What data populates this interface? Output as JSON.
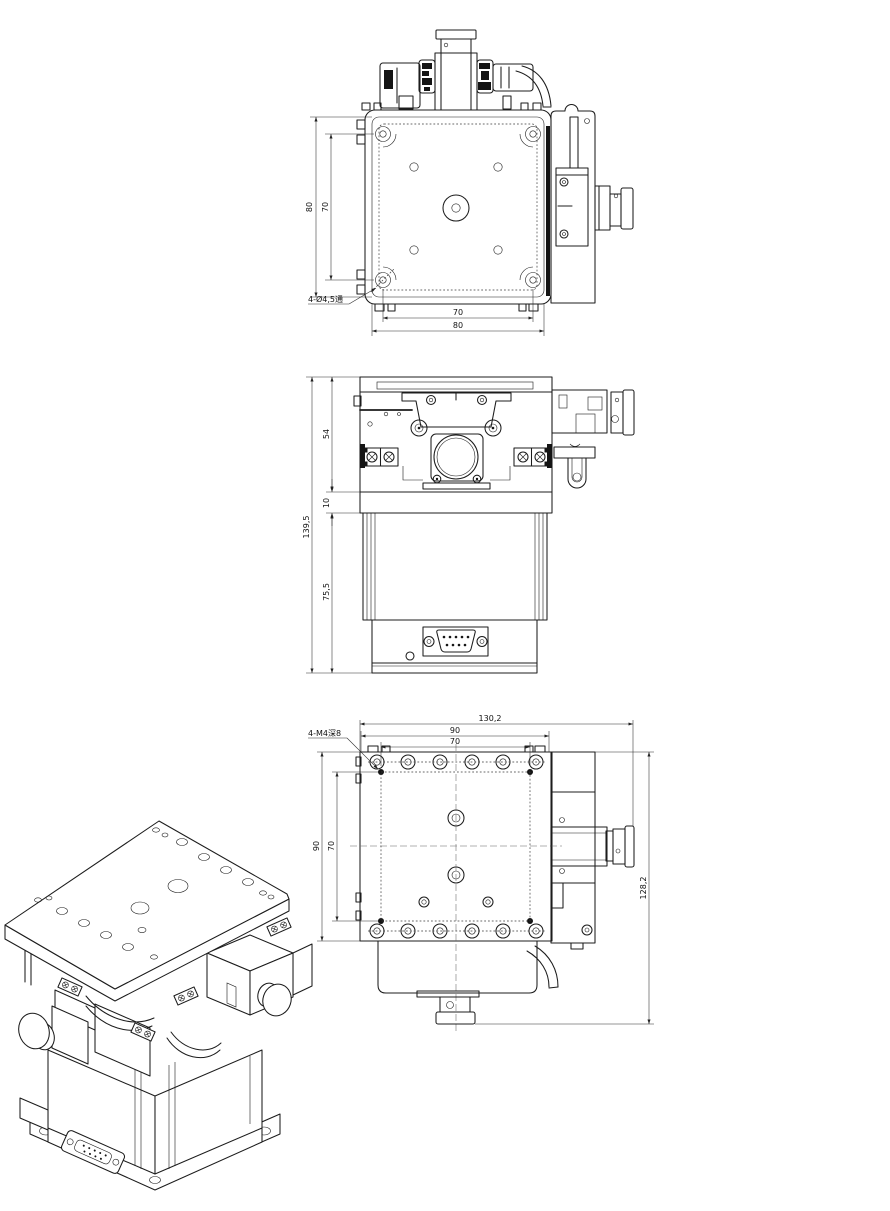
{
  "drawing": {
    "background_color": "#ffffff",
    "line_color": "#1c1c1c",
    "views": {
      "top_view": {
        "dim_table_height": "80",
        "dim_hole_spacing_vertical": "70",
        "dim_hole_spacing_horizontal": "70",
        "dim_table_width": "80",
        "hole_callout": "4-Ø4,5通"
      },
      "front_view": {
        "dim_overall_height": "139,5",
        "dim_upper_section_height": "54",
        "dim_spacer_height": "10",
        "dim_lower_section_height": "75,5"
      },
      "bottom_view": {
        "dim_overall_width": "130,2",
        "dim_body_width": "90",
        "dim_hole_spacing_width": "70",
        "dim_body_height": "90",
        "dim_hole_spacing_height": "70",
        "dim_overall_height": "128,2",
        "hole_callout": "4-M4深8"
      }
    }
  }
}
